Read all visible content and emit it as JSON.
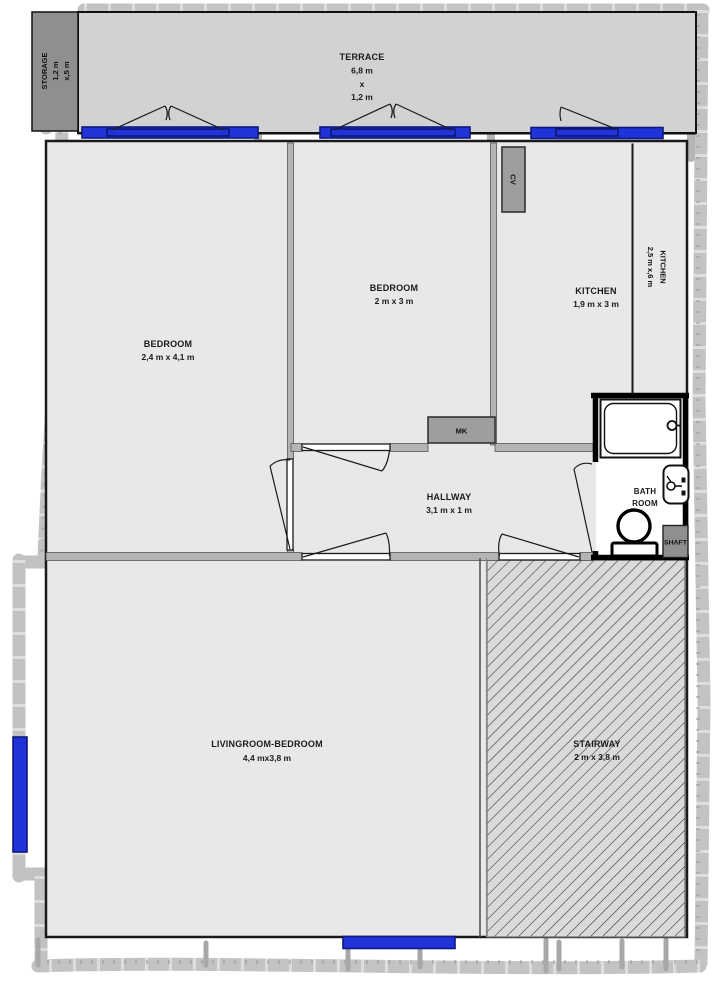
{
  "plan_title": "apartment-floor-plan",
  "rooms": {
    "terrace": {
      "label": "TERRACE",
      "dim_a": "6,8 m",
      "dim_x": "x",
      "dim_b": "1,2 m"
    },
    "storage": {
      "label": "STORAGE",
      "dim_a": "1,2 m",
      "dim_b": "x,5 m"
    },
    "bedroom_left": {
      "label": "BEDROOM",
      "dims": "2,4 m x 4,1 m"
    },
    "bedroom_mid": {
      "label": "BEDROOM",
      "dims": "2 m x 3 m"
    },
    "kitchen": {
      "label": "KITCHEN",
      "dims": "1,9 m x 3 m"
    },
    "kitchen_annex": {
      "label": "KITCHEN",
      "dims": "2,5 m x,6 m"
    },
    "hallway": {
      "label": "HALLWAY",
      "dims": "3,1 m x 1 m"
    },
    "bathroom": {
      "label_line1": "BATH",
      "label_line2": "ROOM"
    },
    "livingroom": {
      "label": "LIVINGROOM-BEDROOM",
      "dims": "4,4 mx3,8 m"
    },
    "stairway": {
      "label": "STAIRWAY",
      "dims": "2 m x 3,8 m"
    },
    "shaft": {
      "label": "SHAFT"
    },
    "cv_unit": {
      "label": "CV"
    },
    "mk_unit": {
      "label": "MK"
    }
  },
  "colors": {
    "window_blue": "#2033d9",
    "wall_dark": "#1a1a1a",
    "room_fill": "#e8e8e8",
    "terrace_fill": "#d2d2d2",
    "utility_gray": "#9e9e9e",
    "sketch_gray": "#bcbcbc"
  }
}
